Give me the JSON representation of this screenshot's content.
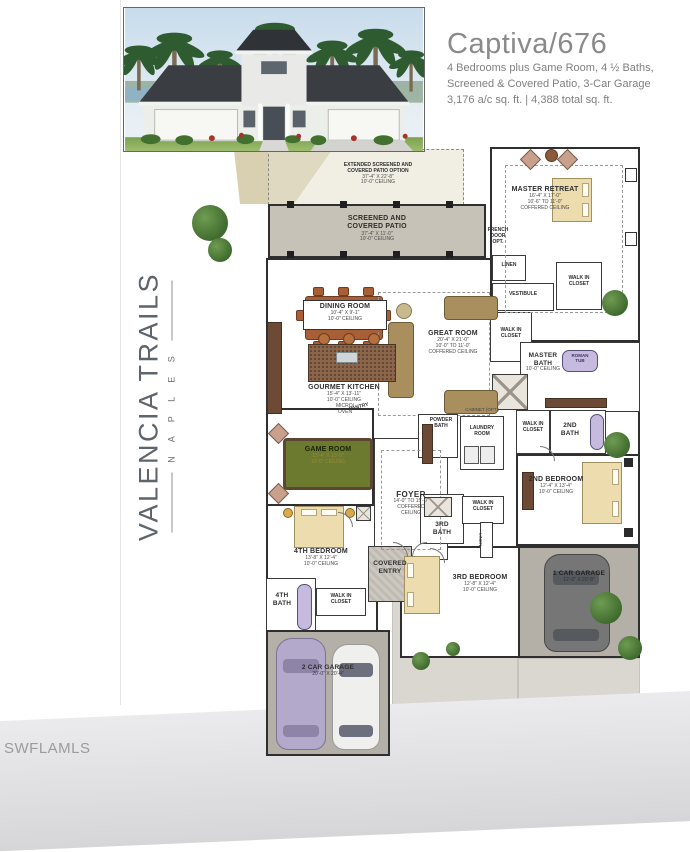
{
  "header": {
    "title": "Captiva/676",
    "line1": "4 Bedrooms plus Game Room, 4 ½ Baths,",
    "line2": "Screened & Covered Patio, 3-Car Garage",
    "line3": "3,176 a/c sq. ft. | 4,388 total sq. ft."
  },
  "brand": {
    "name": "VALENCIA TRAILS",
    "sub": "N A P L E S"
  },
  "watermark": "SWFLAMLS",
  "colors": {
    "wall": "#3a3a3a",
    "patio_gray": "#c6c2b8",
    "garage_gray": "#b4b0a8",
    "bed_tan": "#ecdcae",
    "furniture_brown": "#a85f36",
    "island_brown": "#8a6549",
    "pool_table_green": "#6b7a2e",
    "tub_lavender": "#c6bbde",
    "tree_green": "#4c7a38",
    "driveway": "#dad7d1",
    "title_gray": "#8c8c8c"
  },
  "plan": {
    "ext_patio": {
      "l1": "EXTENDED SCREENED AND",
      "l2": "COVERED PATIO OPTION",
      "dim": "37'-4\" X 22'-8\"",
      "ceil": "10'-0\" CEILING"
    },
    "patio": {
      "l1": "SCREENED AND",
      "l2": "COVERED PATIO",
      "dim": "37'-4\" X 11'-0\"",
      "ceil": "10'-0\" CEILING"
    },
    "french_door": {
      "l1": "FRENCH",
      "l2": "DOOR",
      "l3": "OPT."
    },
    "master_retreat": {
      "name": "MASTER RETREAT",
      "dim": "16'-4\" X 17'-0\"",
      "ceil": "10'-6\" TO 11'-0\"",
      "ceil2": "COFFERED CEILING"
    },
    "linen": "LINEN",
    "linen2": "LINEN",
    "vestibule": "VESTIBULE",
    "wic1": {
      "l1": "WALK IN",
      "l2": "CLOSET"
    },
    "wic2": {
      "l1": "WALK IN",
      "l2": "CLOSET"
    },
    "master_bath": {
      "l1": "MASTER",
      "l2": "BATH",
      "ceil": "10'-0\" CEILING"
    },
    "roman_tub": {
      "l1": "ROMAN",
      "l2": "TUB"
    },
    "dining": {
      "name": "DINING ROOM",
      "dim": "10'-4\" X 9'-1\"",
      "ceil": "10'-0\" CEILING"
    },
    "great_room": {
      "name": "GREAT ROOM",
      "dim": "20'-4\" X 21'-0\"",
      "ceil": "10'-0\" TO 11'-0\"",
      "ceil2": "COFFERED CEILING"
    },
    "kitchen": {
      "name": "GOURMET KITCHEN",
      "dim": "15'-4\" X 13'-11\"",
      "ceil": "10'-0\" CEILING",
      "micro": "MICRO/",
      "oven": "OVEN"
    },
    "pantry": "PANTRY",
    "game_room": {
      "name": "GAME ROOM",
      "dim": "13'-4\" X 13'-0\"",
      "ceil": "10'-0\" CEILING"
    },
    "foyer": {
      "name": "FOYER",
      "dim": "14'-0\" TO 15'-0\"",
      "ceil": "COFFERED",
      "ceil2": "CEILING"
    },
    "powder": {
      "l1": "POWDER",
      "l2": "BATH"
    },
    "laundry": {
      "l1": "LAUNDRY",
      "l2": "ROOM"
    },
    "cabinet": "CABINET (OPT.)",
    "wic_2nd": {
      "l1": "WALK IN",
      "l2": "CLOSET"
    },
    "bath2": {
      "l1": "2ND",
      "l2": "BATH"
    },
    "bed2": {
      "name": "2ND BEDROOM",
      "dim": "12'-4\" X 13'-4\"",
      "ceil": "10'-0\" CEILING"
    },
    "bath3": {
      "l1": "3RD",
      "l2": "BATH"
    },
    "wic_3rd": {
      "l1": "WALK IN",
      "l2": "CLOSET"
    },
    "bed3": {
      "name": "3RD BEDROOM",
      "dim": "12'-8\" X 12'-4\"",
      "ceil": "10'-0\" CEILING"
    },
    "garage1": {
      "name": "1 CAR GARAGE",
      "dim": "12'-0\" X 20'-8\""
    },
    "covered_entry": {
      "l1": "COVERED",
      "l2": "ENTRY"
    },
    "bed4": {
      "name": "4TH BEDROOM",
      "dim": "13'-8\" X 12'-4\"",
      "ceil": "10'-0\" CEILING"
    },
    "bath4": {
      "l1": "4TH",
      "l2": "BATH"
    },
    "wic_4th": {
      "l1": "WALK IN",
      "l2": "CLOSET"
    },
    "garage2": {
      "name": "2 CAR GARAGE",
      "dim": "20'-0\" X 20'-4\""
    }
  }
}
